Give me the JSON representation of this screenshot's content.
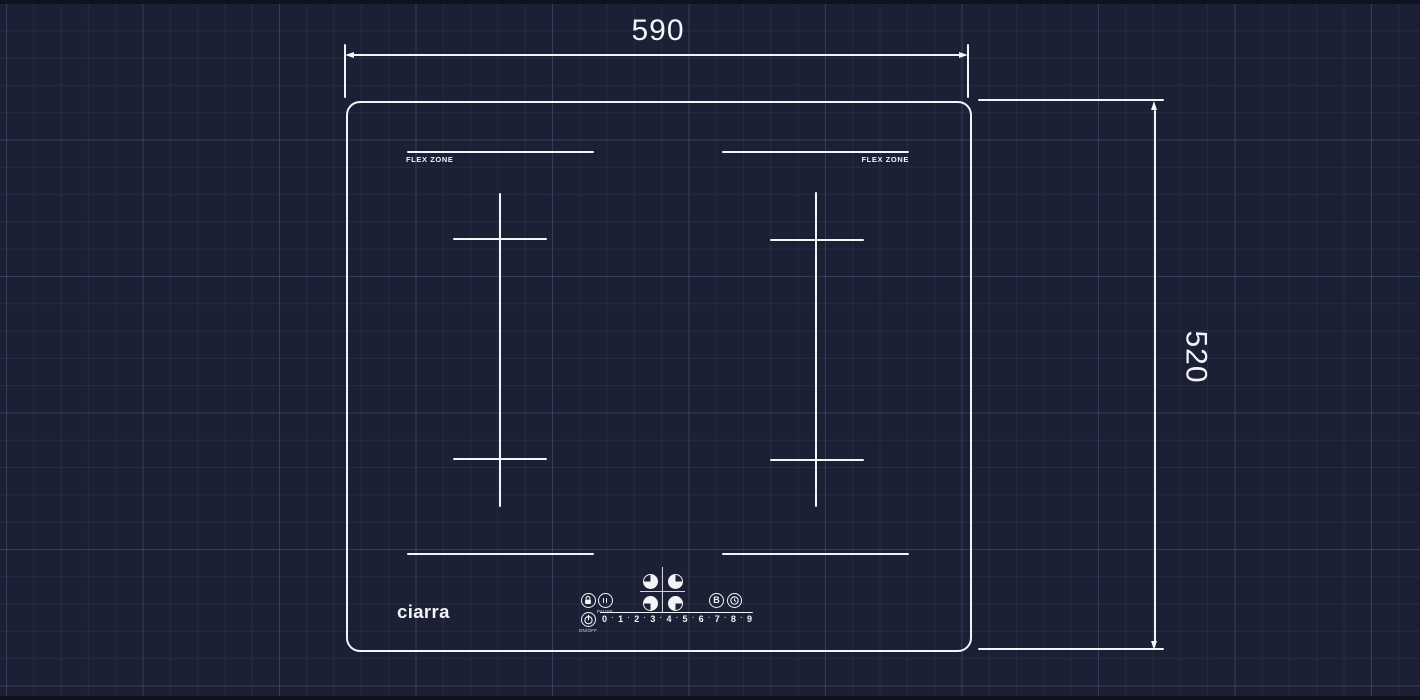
{
  "diagram": {
    "kind": "induction-hob-dimension-drawing",
    "dimensions": {
      "width_label": "590",
      "height_label": "520"
    },
    "flex_zone_left_label": "FLEX ZONE",
    "flex_zone_right_label": "FLEX ZONE",
    "brand_logo": "ciarra",
    "control_panel": {
      "boost_label": "B",
      "pause_label": "PAUSE",
      "power_label": "ON/OFF",
      "power_levels": [
        "0",
        "1",
        "2",
        "3",
        "4",
        "5",
        "6",
        "7",
        "8",
        "9"
      ],
      "level_separator": "·",
      "icons": {
        "lock": "lock-icon",
        "pause": "pause-icon",
        "zone_back_left": "zone-back-left-icon",
        "zone_back_right": "zone-back-right-icon",
        "zone_front_left": "zone-front-left-icon",
        "zone_front_right": "zone-front-right-icon",
        "boost": "boost-icon",
        "timer": "timer-clock-icon",
        "power": "power-icon"
      }
    },
    "colors": {
      "background": "#1b2035",
      "grid_line": "#39415f",
      "stroke": "#f2f4f8"
    }
  }
}
